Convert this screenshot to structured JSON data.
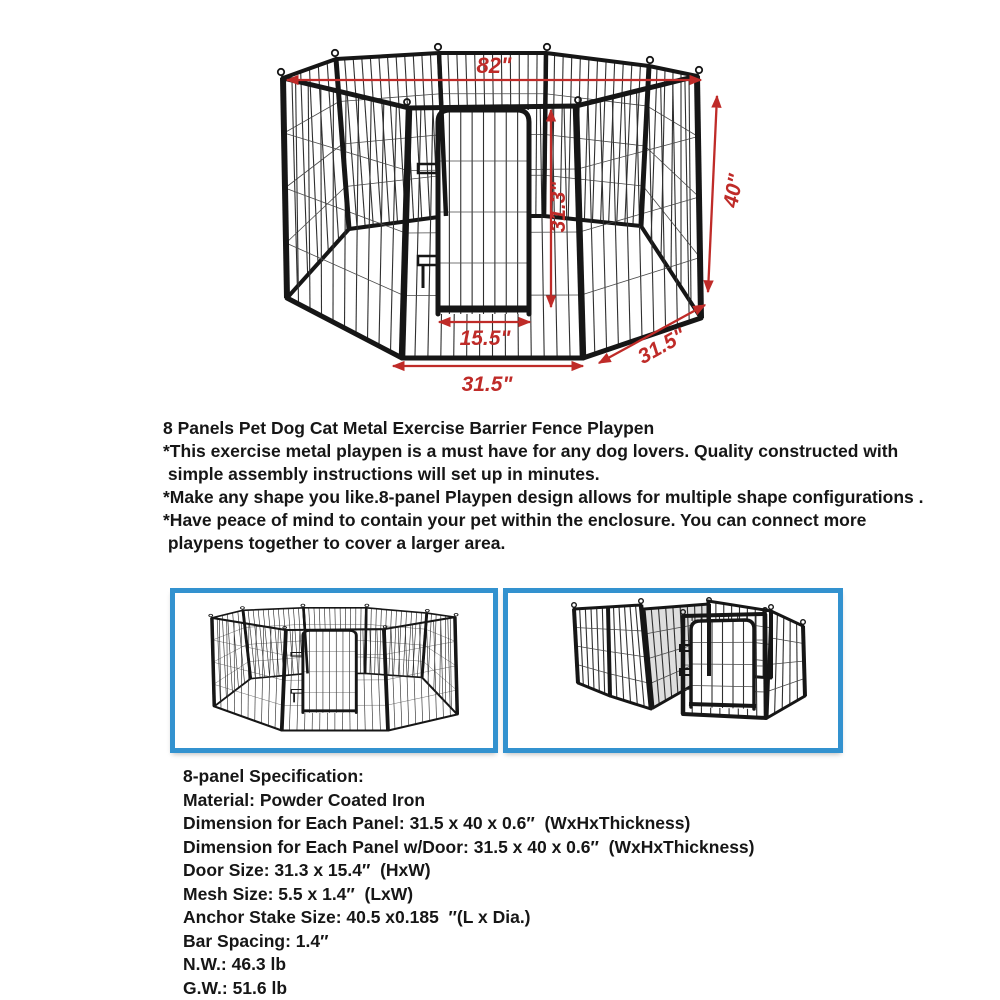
{
  "diagram": {
    "name": "8-panel playpen dimension diagram",
    "dims": {
      "top_width": "82\"",
      "panel_height": "40\"",
      "door_height": "31.3\"",
      "door_width": "15.5\"",
      "front_panel_width": "31.5\"",
      "side_panel_width": "31.5\""
    }
  },
  "description": {
    "title": "8 Panels Pet Dog Cat Metal Exercise Barrier Fence Playpen",
    "lines": [
      "*This exercise metal playpen is a must have for any dog lovers. Quality constructed with",
      " simple assembly instructions will set up in minutes.",
      "*Make any shape you like.8-panel Playpen design allows for multiple shape configurations .",
      "*Have peace of mind to contain your pet within the enclosure. You can connect more",
      " playpens together to cover a larger area."
    ]
  },
  "gallery": {
    "items": [
      {
        "label": "octagon configuration"
      },
      {
        "label": "square configuration"
      }
    ]
  },
  "specs": {
    "title": "8-panel Specification:",
    "items": [
      "Material: Powder Coated Iron",
      "Dimension for Each Panel: 31.5 x 40 x 0.6″  (WxHxThickness)",
      "Dimension for Each Panel w/Door: 31.5 x 40 x 0.6″  (WxHxThickness)",
      "Door Size: 31.3 x 15.4″  (HxW)",
      "Mesh Size: 5.5 x 1.4″  (LxW)",
      "Anchor Stake Size: 40.5 x0.185  ″(L x Dia.)",
      "Bar Spacing: 1.4″",
      "N.W.: 46.3 lb",
      "G.W.: 51.6 lb"
    ]
  },
  "colors": {
    "dimension_red": "#bf2b28",
    "frame_black": "#161616",
    "gallery_border_blue": "#3392cf"
  }
}
